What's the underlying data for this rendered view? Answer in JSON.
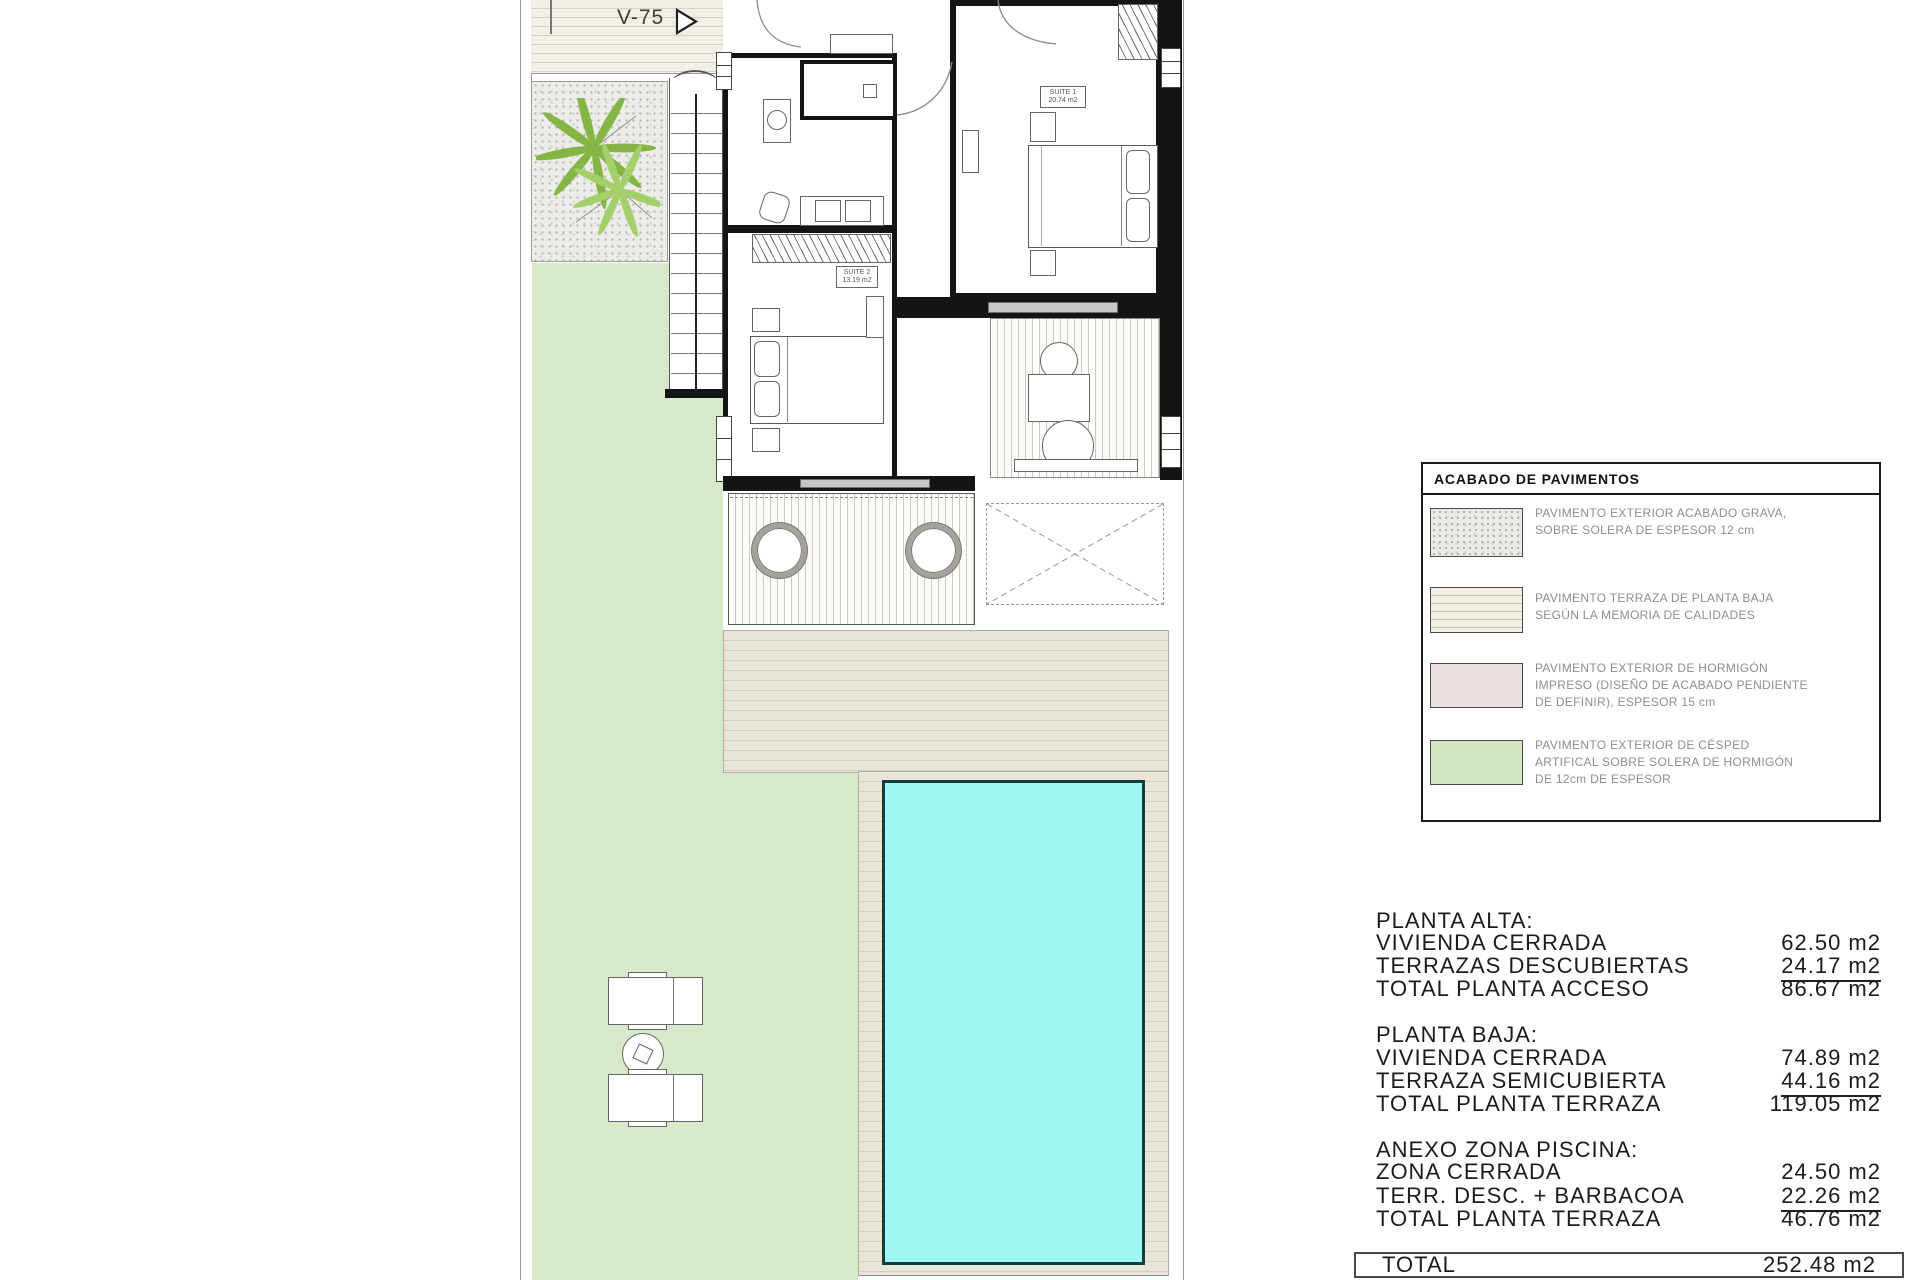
{
  "plan": {
    "street_label": "V-75",
    "suite1": {
      "name": "SUITE 1",
      "area": "20.74 m2"
    },
    "suite2": {
      "name": "SUITE 2",
      "area": "13.19 m2"
    }
  },
  "legend": {
    "title": "ACABADO DE PAVIMENTOS",
    "items": [
      {
        "swatch": "gravel-texture",
        "lines": [
          "PAVIMENTO EXTERIOR ACABADO GRAVA,",
          "SOBRE SOLERA DE ESPESOR 12 cm"
        ]
      },
      {
        "swatch": "terrace-stripes",
        "lines": [
          "PAVIMENTO TERRAZA DE PLANTA BAJA",
          "SEGÚN LA MEMORIA DE CALIDADES"
        ]
      },
      {
        "swatch": "printed-concrete",
        "lines": [
          "PAVIMENTO EXTERIOR DE HORMIGÓN",
          "IMPRESO (DISEÑO DE ACABADO PENDIENTE",
          "DE DEFINIR), ESPESOR 15 cm"
        ]
      },
      {
        "swatch": "artificial-grass",
        "lines": [
          "PAVIMENTO EXTERIOR DE CÉSPED",
          "ARTIFICAL SOBRE SOLERA DE HORMIGÓN",
          "DE 12cm DE ESPESOR"
        ]
      }
    ]
  },
  "areas": {
    "sections": [
      {
        "title": "PLANTA ALTA:",
        "rows": [
          {
            "label": "VIVIENDA CERRADA",
            "value": "62.50 m2"
          },
          {
            "label": "TERRAZAS DESCUBIERTAS",
            "value": "24.17 m2"
          },
          {
            "label": "TOTAL PLANTA ACCESO",
            "value": "86.67 m2"
          }
        ]
      },
      {
        "title": "PLANTA BAJA:",
        "rows": [
          {
            "label": "VIVIENDA CERRADA",
            "value": "74.89 m2"
          },
          {
            "label": "TERRAZA SEMICUBIERTA",
            "value": "44.16 m2"
          },
          {
            "label": "TOTAL PLANTA TERRAZA",
            "value": "119.05 m2"
          }
        ]
      },
      {
        "title": "ANEXO ZONA PISCINA:",
        "rows": [
          {
            "label": "ZONA CERRADA",
            "value": "24.50 m2"
          },
          {
            "label": "TERR. DESC. + BARBACOA",
            "value": "22.26 m2"
          },
          {
            "label": "TOTAL PLANTA TERRAZA",
            "value": "46.76 m2"
          }
        ]
      }
    ],
    "total_label": "TOTAL",
    "total_value": "252.48 m2"
  },
  "colors": {
    "pool_fill": "#a2f7f5",
    "pool_border": "#123e3e",
    "lawn_green": "#d8e8ca",
    "terrace_beige": "#eae5d9",
    "legend_grass": "#d3e7c3",
    "legend_concrete": "#e9e1dd",
    "wall_black": "#141414"
  }
}
